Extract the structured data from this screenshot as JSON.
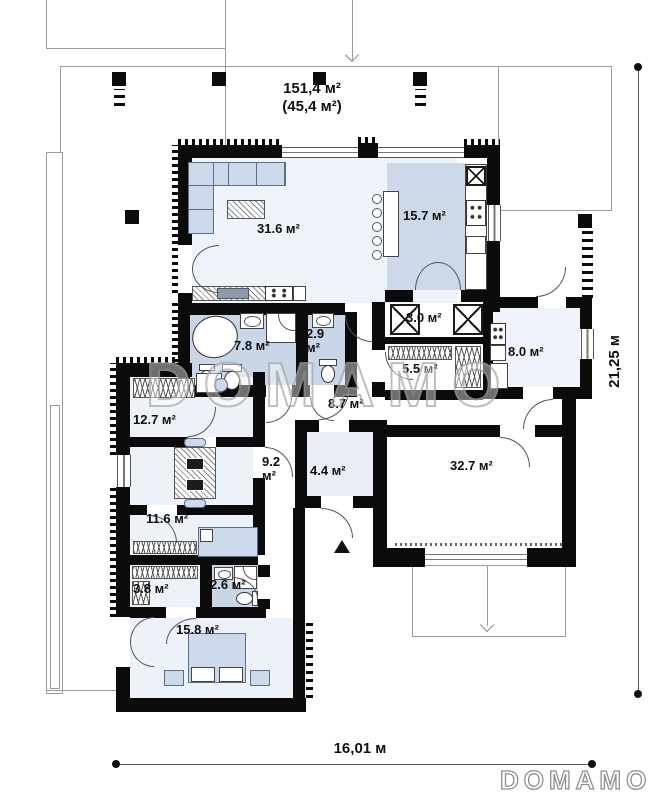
{
  "header": {
    "total_area": "151,4 м²",
    "secondary_area": "(45,4 м²)"
  },
  "dimensions": {
    "width_label": "16,01 м",
    "height_label": "21,25 м"
  },
  "watermark": {
    "text": "DOMAMO"
  },
  "logo": {
    "text": "DOMAMO"
  },
  "rooms": {
    "living": "31.6 м²",
    "kitchen_dining": "15.7 м²",
    "pantry": "3.0 м²",
    "wardrobe_hall": "5.5 м²",
    "utility": "8.0 м²",
    "bathroom1": "7.8 м²",
    "wc_value": "2.9",
    "wc_unit": "м²",
    "hallway": "8.7 м²",
    "bedroom1": "12.7 м²",
    "study_value": "9.2",
    "study_unit": "м²",
    "vestibule": "4.4 м²",
    "garage": "32.7 м²",
    "bedroom2": "11.6 м²",
    "closet": "3.8 м²",
    "bathroom2": "2.6 м²",
    "bedroom3": "15.8 м²"
  },
  "colors": {
    "wall": "#0b0b0b",
    "room_light": "#edf2f9",
    "room_blue": "#c9d6e8",
    "furniture": "#ccd9ea",
    "outline_gray": "#9b9b9b",
    "watermark_gray": "#a9a9a9"
  }
}
